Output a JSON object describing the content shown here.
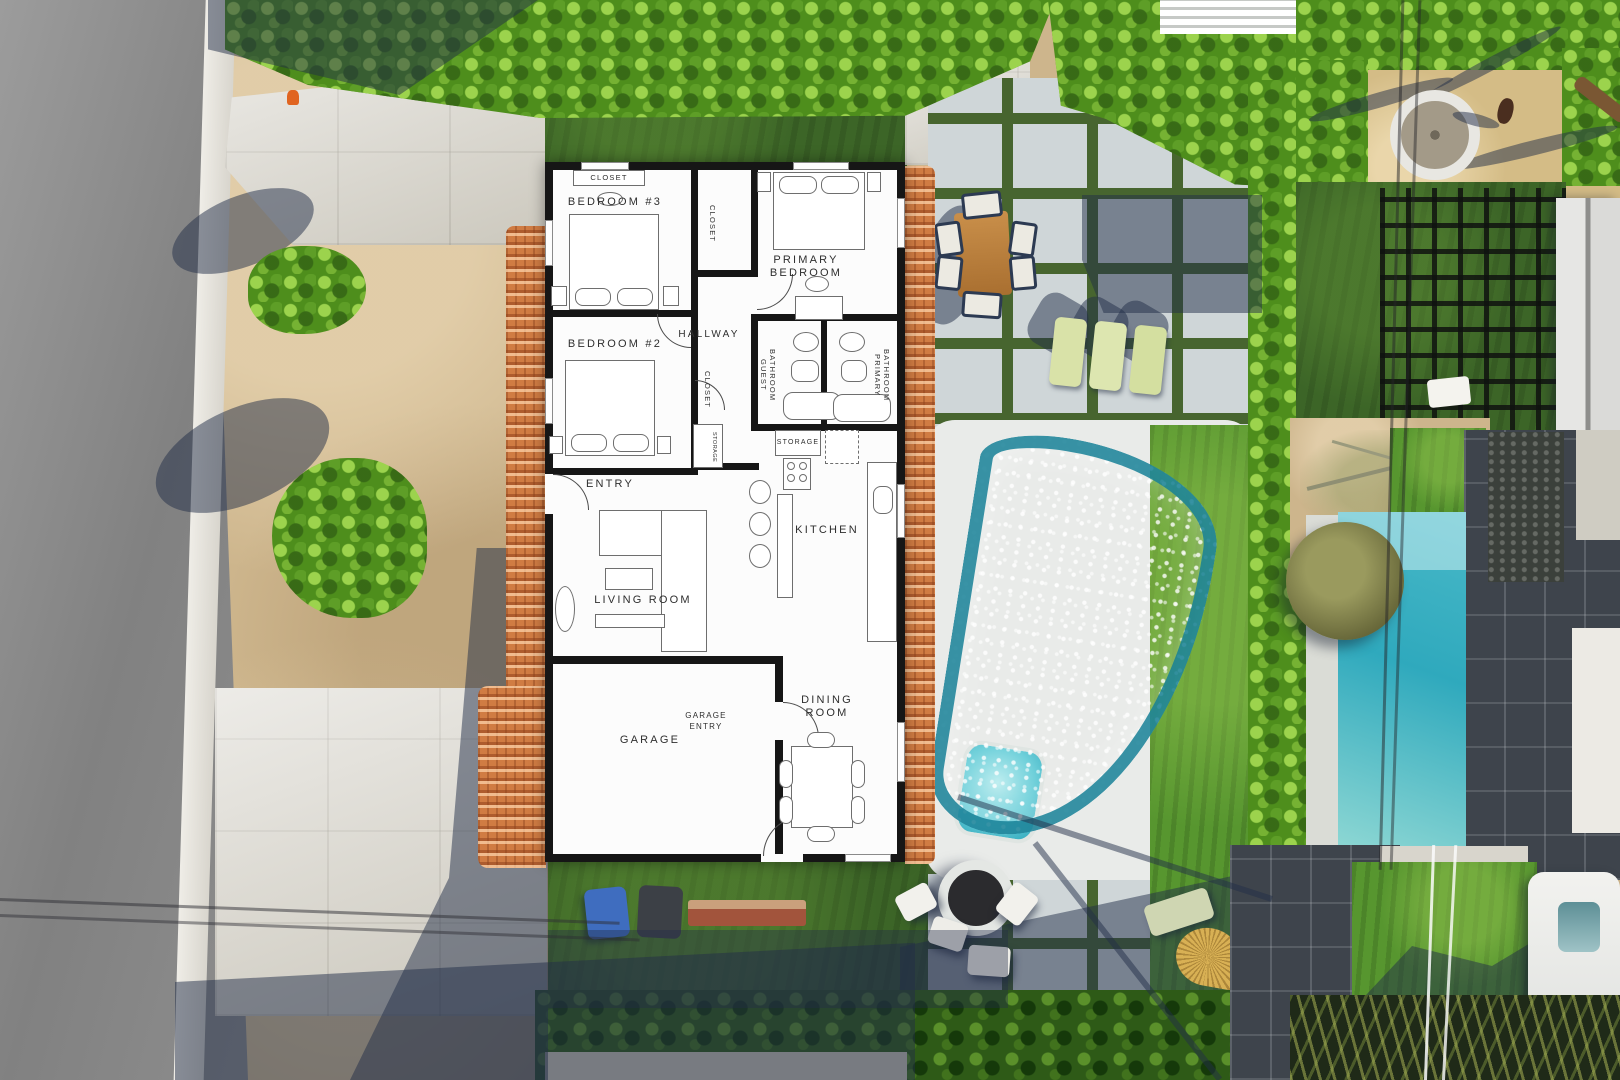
{
  "floor_plan": {
    "closet_bedroom3": "CLOSET",
    "bedroom3": "BEDROOM #3",
    "closet_primary": "CLOSET",
    "primary_bedroom": "PRIMARY\nBEDROOM",
    "hallway": "HALLWAY",
    "bedroom2": "BEDROOM #2",
    "closet_bedroom2": "CLOSET",
    "guest_bathroom": "GUEST\nBATHROOM",
    "primary_bathroom": "PRIMARY\nBATHROOM",
    "storage_closet": "STORAGE",
    "storage": "STORAGE",
    "entry": "ENTRY",
    "living_room": "LIVING ROOM",
    "kitchen": "KITCHEN",
    "garage": "GARAGE",
    "garage_entry": "GARAGE\nENTRY",
    "dining_room": "DINING\nROOM"
  },
  "colors": {
    "plan_wall": "#161616",
    "plan_floor": "#fcfcfc",
    "roof_tile": "#d07c43",
    "road": "#8d8d8d",
    "curb": "#e9e7e1",
    "dirt": "#cdb58c",
    "concrete": "#d7d4cb",
    "hedge_green": "#4e8e1c",
    "lawn_green": "#3c6527",
    "paver": "#cfd6d8",
    "paver_joint": "#47652f",
    "pool_aqua": "#9ce4ec",
    "pool_teal": "#2fa9bd",
    "deck_white": "#e9ebe9",
    "wood_table": "#b97f3e",
    "lounger": "#d9e2a8",
    "shadow_navy": "#222e48",
    "gravel_tan": "#d4bc86",
    "umbrella_gold": "#d8b054",
    "trash_bin_blue": "#3f6dbf"
  }
}
